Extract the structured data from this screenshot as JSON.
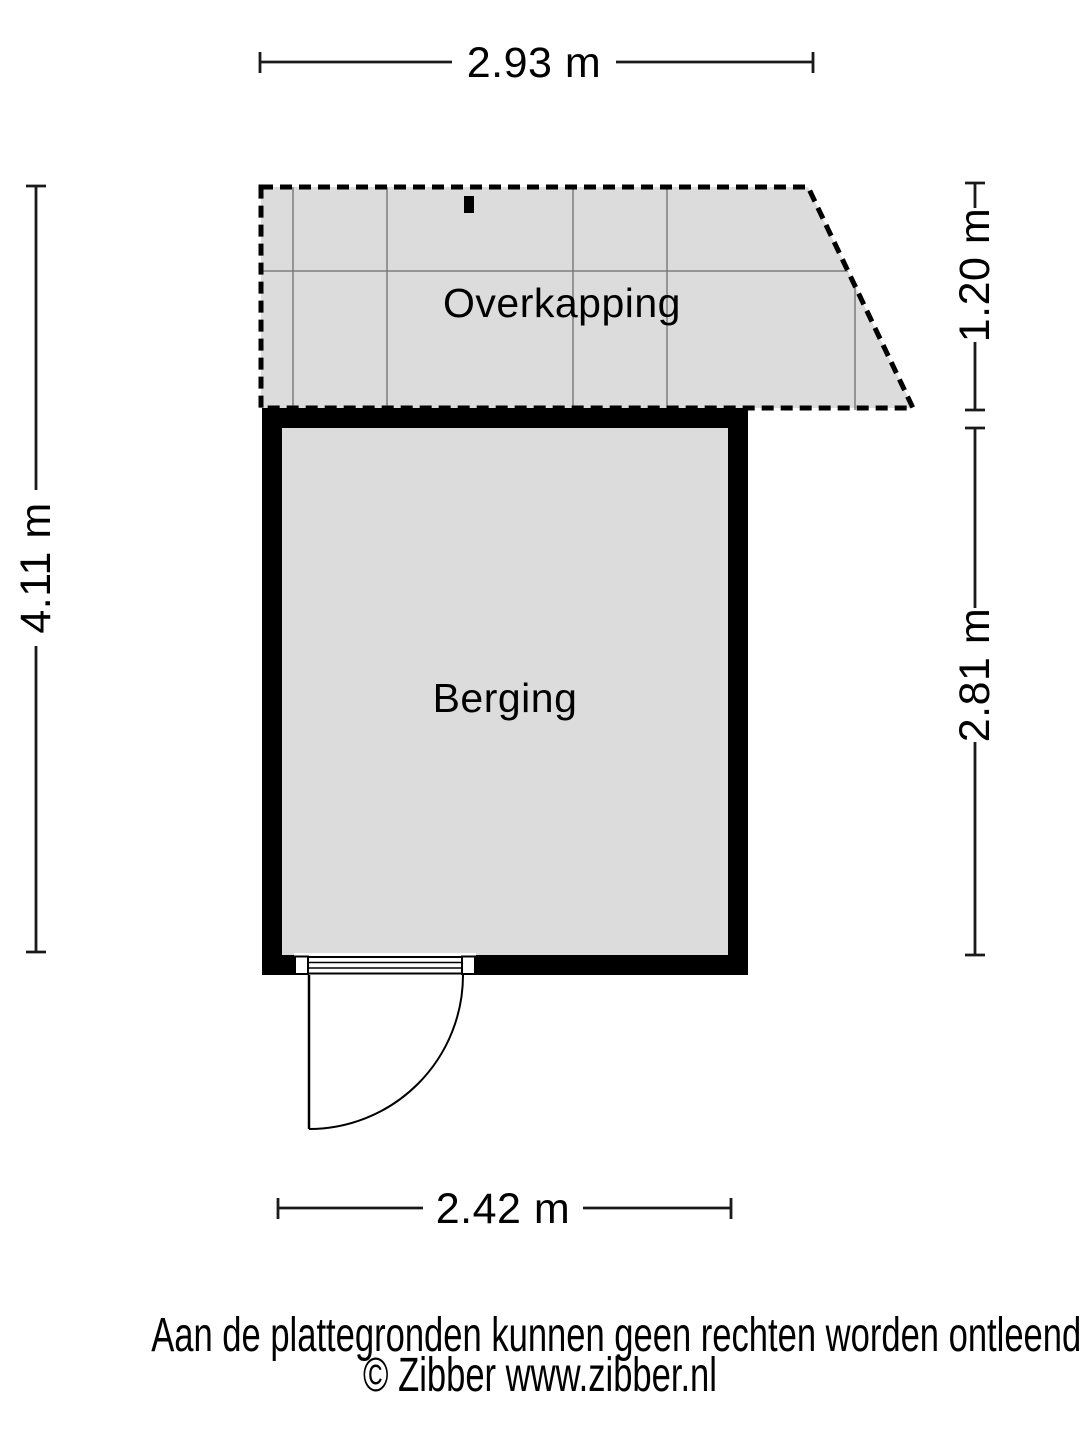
{
  "floorplan": {
    "rooms": [
      {
        "name": "Overkapping"
      },
      {
        "name": "Berging"
      }
    ],
    "dimensions": {
      "top": "2.93 m",
      "left": "4.11 m",
      "right_upper": "1.20 m",
      "right_lower": "2.81 m",
      "bottom": "2.42 m"
    },
    "colors": {
      "room_fill": "#dcdcdc",
      "wall": "#000000",
      "grid_line": "#7d7d7d",
      "dimension_line": "#1a1a1a"
    }
  },
  "footer": {
    "disclaimer": "Aan de plattegronden kunnen geen rechten worden ontleend",
    "credit": "© Zibber www.zibber.nl"
  }
}
